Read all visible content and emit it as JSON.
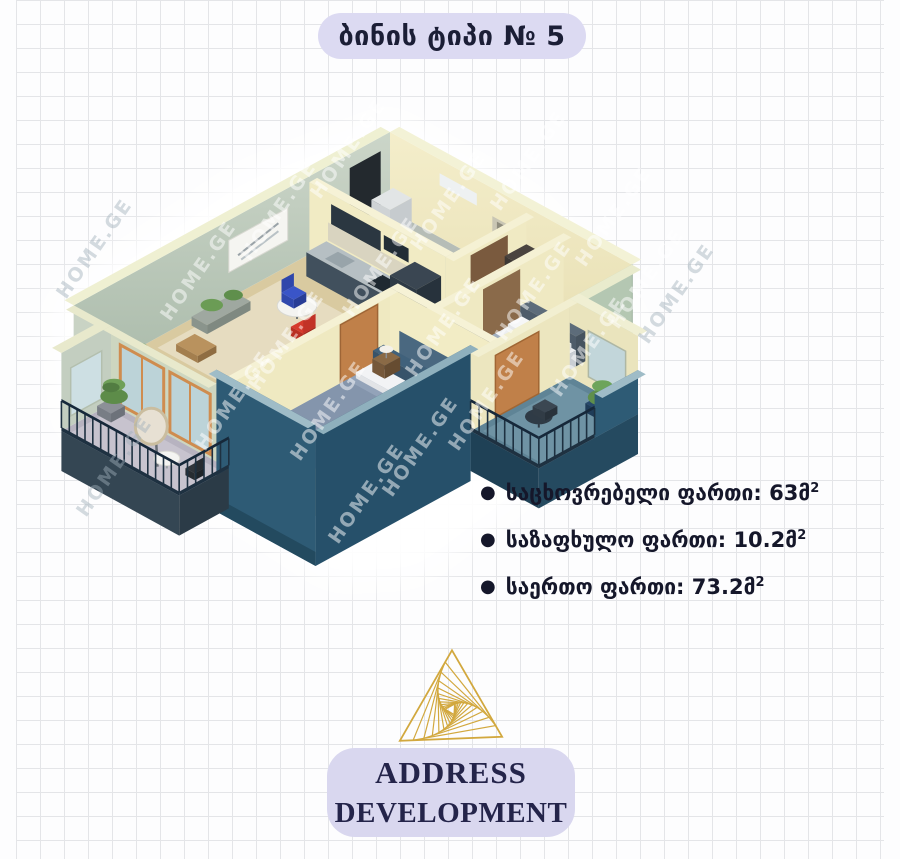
{
  "title": "ბინის ტიპი № 5",
  "plan": {
    "watermark": "HOME.GE"
  },
  "areas": {
    "items": [
      {
        "label": "საცხოვრებელი ფართი: 63მ",
        "sup": "2"
      },
      {
        "label": "საზაფხულო ფართი: 10.2მ",
        "sup": "2"
      },
      {
        "label": "საერთო ფართი: 73.2მ",
        "sup": "2"
      }
    ]
  },
  "brand": {
    "line1": "ADDRESS",
    "line2": "DEVELOPMENT"
  },
  "colors": {
    "pill_lavender": "#dcdaf2",
    "text_navy": "#1b1e36",
    "gold": "#d2a83e",
    "wall_sage": "#b7c9b4",
    "wall_cream": "#f2ecc6",
    "front_teal": "#2e5b75",
    "railing_navy": "#1e3141",
    "balcony_floor_teal": "#6f93a4"
  }
}
